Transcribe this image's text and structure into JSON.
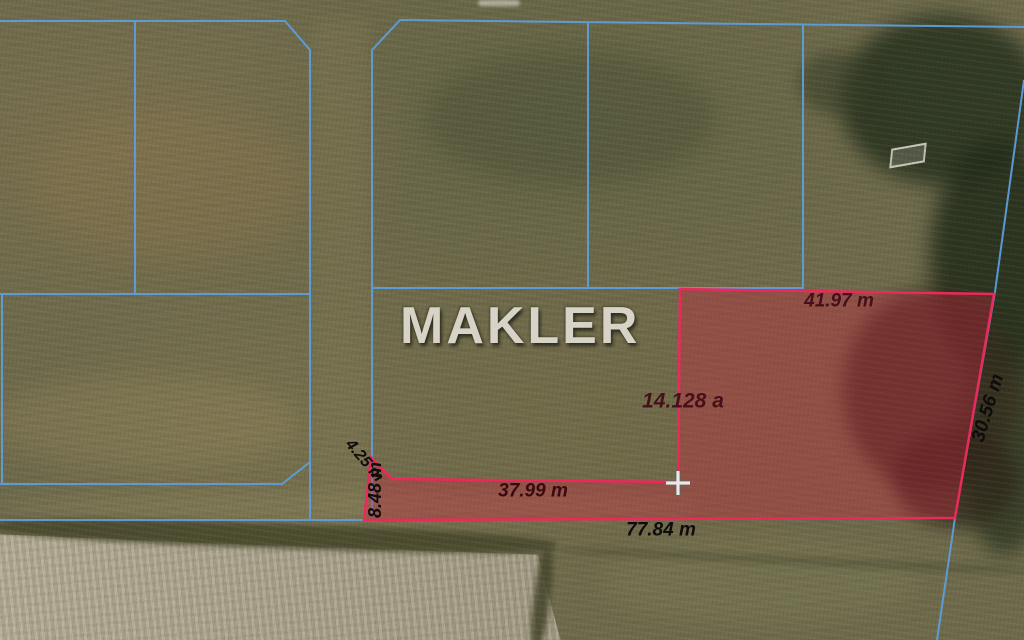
{
  "watermark": "MAKLER",
  "map": {
    "highlight_area_label": "14.128 a",
    "measurements": {
      "top_edge": "41.97 m",
      "right_edge": "30.56 m",
      "strip_top_edge": "37.99 m",
      "bottom_edge": "77.84 m",
      "left_edge": "8.48 m",
      "slant_edge": "4.25 m"
    }
  },
  "colors": {
    "boundary_blue": "#5d9edd",
    "parcel_stroke": "#e92a5a",
    "parcel_fill": "rgba(203,35,64,0.36)",
    "label_dark_red": "#45101a",
    "label_black": "#0d0d0d",
    "crosshair_white": "#f2f6f3"
  }
}
